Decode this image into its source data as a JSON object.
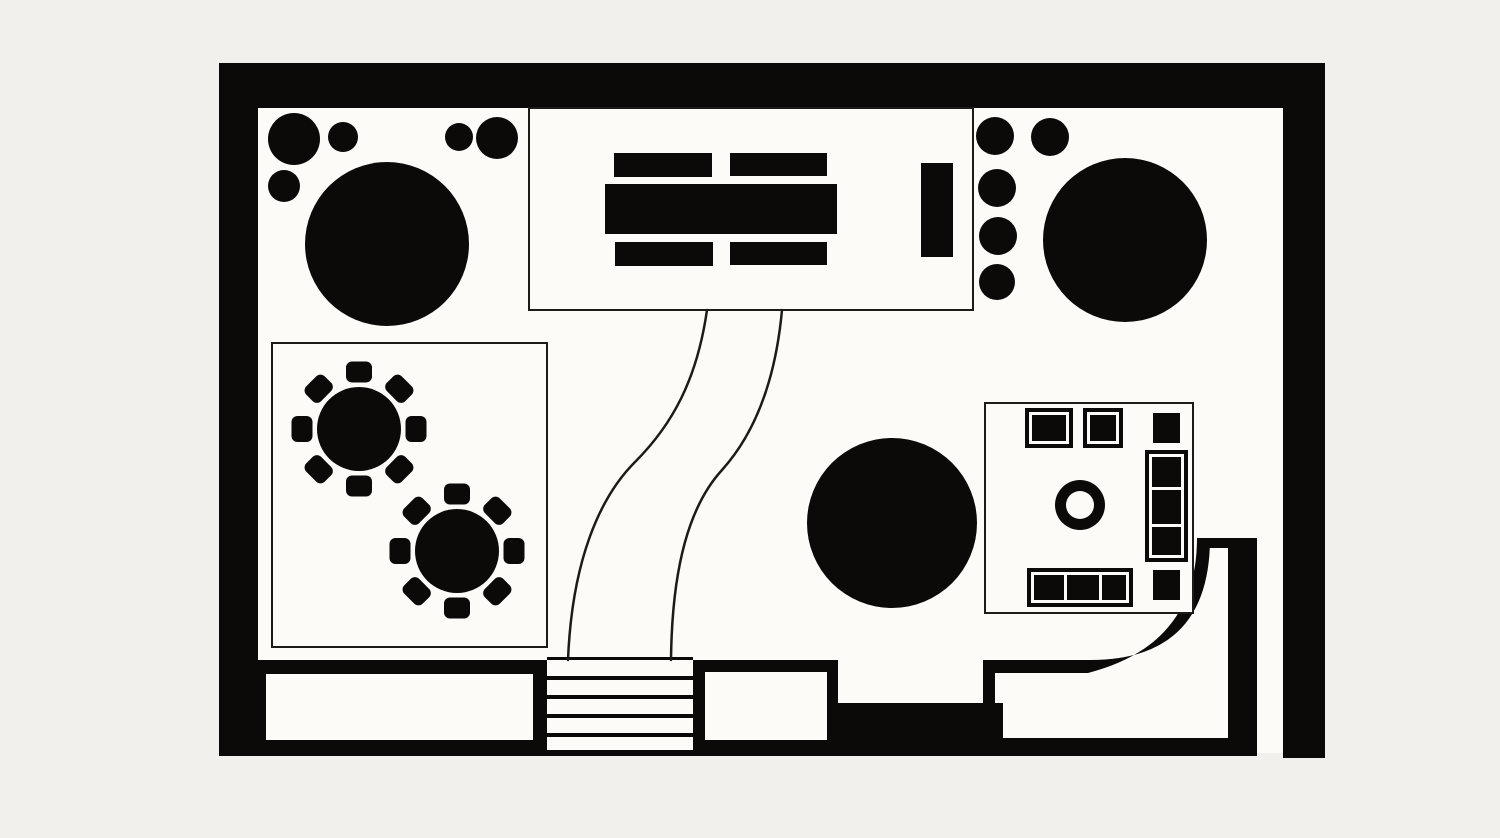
{
  "palette": {
    "ink": "#0b0a08",
    "floor": "#fcfbf8",
    "line": "#1c1b18",
    "outside": "#f1f0ec"
  },
  "plan": {
    "kind": "floor-plan",
    "style": "black-and-white",
    "canvas": {
      "width": 1500,
      "height": 838
    }
  },
  "shapes": [
    {
      "type": "rect",
      "name": "floor",
      "x": 258,
      "y": 108,
      "w": 1026,
      "h": 645,
      "fill": "floor"
    },
    {
      "type": "rect",
      "name": "wall-top",
      "x": 219,
      "y": 63,
      "w": 1106,
      "h": 45,
      "fill": "ink"
    },
    {
      "type": "rect",
      "name": "wall-left",
      "x": 219,
      "y": 63,
      "w": 39,
      "h": 693,
      "fill": "ink"
    },
    {
      "type": "rect",
      "name": "wall-right",
      "x": 1283,
      "y": 63,
      "w": 42,
      "h": 695,
      "fill": "ink"
    },
    {
      "type": "rect",
      "name": "wall-bottom-line",
      "x": 219,
      "y": 750,
      "w": 1038,
      "h": 6,
      "fill": "ink"
    },
    {
      "type": "rect",
      "name": "wall-bottom-left",
      "x": 258,
      "y": 660,
      "w": 289,
      "h": 93,
      "fill": "ink"
    },
    {
      "type": "rect",
      "name": "door-opening-left",
      "x": 266,
      "y": 674,
      "w": 267,
      "h": 66,
      "fill": "floor"
    },
    {
      "type": "rect",
      "name": "wall-bottom-mid",
      "x": 693,
      "y": 660,
      "w": 145,
      "h": 93,
      "fill": "ink"
    },
    {
      "type": "rect",
      "name": "door-opening-mid",
      "x": 705,
      "y": 672,
      "w": 122,
      "h": 68,
      "fill": "floor"
    },
    {
      "type": "rect",
      "name": "bench-platform",
      "x": 838,
      "y": 703,
      "w": 165,
      "h": 50,
      "fill": "ink"
    },
    {
      "type": "rect",
      "name": "wall-post",
      "x": 983,
      "y": 660,
      "w": 12,
      "h": 80,
      "fill": "ink"
    },
    {
      "type": "rect",
      "name": "wall-bottom-right-band",
      "x": 997,
      "y": 738,
      "w": 260,
      "h": 15,
      "fill": "ink"
    },
    {
      "type": "path",
      "name": "curved-wall",
      "d": "M995,660 H1090 Q1210,660 1210,538 L1197,538 Q1197,645 1088,673 L995,673 Z",
      "fill": "ink"
    },
    {
      "type": "rect",
      "name": "curved-wall-cap",
      "x": 1207,
      "y": 538,
      "w": 50,
      "h": 10,
      "fill": "ink"
    },
    {
      "type": "rect",
      "name": "wall-right-inner",
      "x": 1228,
      "y": 548,
      "w": 29,
      "h": 205,
      "fill": "ink"
    },
    {
      "type": "rect",
      "name": "stairs-top-edge",
      "x": 547,
      "y": 657,
      "w": 146,
      "h": 3,
      "fill": "ink"
    },
    {
      "type": "rect",
      "name": "stair-tread-1",
      "x": 547,
      "y": 676,
      "w": 146,
      "h": 4,
      "fill": "ink"
    },
    {
      "type": "rect",
      "name": "stair-tread-2",
      "x": 547,
      "y": 695,
      "w": 146,
      "h": 4,
      "fill": "ink"
    },
    {
      "type": "rect",
      "name": "stair-tread-3",
      "x": 547,
      "y": 714,
      "w": 146,
      "h": 4,
      "fill": "ink"
    },
    {
      "type": "rect",
      "name": "stair-tread-4",
      "x": 547,
      "y": 733,
      "w": 146,
      "h": 4,
      "fill": "ink"
    },
    {
      "type": "rect",
      "name": "room-conference",
      "x": 529,
      "y": 108,
      "w": 444,
      "h": 202,
      "fill": "floor",
      "stroke": "line",
      "sw": 2
    },
    {
      "type": "rect",
      "name": "conference-chair-nw",
      "x": 614,
      "y": 153,
      "w": 98,
      "h": 24,
      "fill": "ink"
    },
    {
      "type": "rect",
      "name": "conference-chair-ne",
      "x": 730,
      "y": 153,
      "w": 97,
      "h": 23,
      "fill": "ink"
    },
    {
      "type": "rect",
      "name": "conference-table",
      "x": 605,
      "y": 184,
      "w": 232,
      "h": 50,
      "fill": "ink"
    },
    {
      "type": "rect",
      "name": "conference-chair-sw",
      "x": 615,
      "y": 242,
      "w": 98,
      "h": 24,
      "fill": "ink"
    },
    {
      "type": "rect",
      "name": "conference-chair-se",
      "x": 730,
      "y": 242,
      "w": 97,
      "h": 23,
      "fill": "ink"
    },
    {
      "type": "rect",
      "name": "lectern",
      "x": 921,
      "y": 163,
      "w": 32,
      "h": 94,
      "fill": "ink"
    },
    {
      "type": "path",
      "name": "walkway-curve-left",
      "d": "M707,310 C697,380 672,425 635,462 C600,497 572,560 568,660",
      "stroke": "line",
      "sw": 2.5
    },
    {
      "type": "path",
      "name": "walkway-curve-right",
      "d": "M782,310 C776,375 758,430 722,470 C690,505 672,565 671,660",
      "stroke": "line",
      "sw": 2.5
    },
    {
      "type": "circle",
      "name": "planter-large-topleft",
      "cx": 294,
      "cy": 139,
      "r": 26,
      "fill": "ink"
    },
    {
      "type": "circle",
      "name": "planter-small-topleft-1",
      "cx": 343,
      "cy": 137,
      "r": 15,
      "fill": "ink"
    },
    {
      "type": "circle",
      "name": "planter-small-topleft-2",
      "cx": 459,
      "cy": 137,
      "r": 14,
      "fill": "ink"
    },
    {
      "type": "circle",
      "name": "planter-small-topleft-3",
      "cx": 497,
      "cy": 138,
      "r": 21,
      "fill": "ink"
    },
    {
      "type": "circle",
      "name": "planter-small-topleft-4",
      "cx": 284,
      "cy": 186,
      "r": 16,
      "fill": "ink"
    },
    {
      "type": "circle",
      "name": "round-table-large-topleft",
      "cx": 387,
      "cy": 244,
      "r": 82,
      "fill": "ink"
    },
    {
      "type": "circle",
      "name": "planter-topright-1",
      "cx": 995,
      "cy": 136,
      "r": 19,
      "fill": "ink"
    },
    {
      "type": "circle",
      "name": "planter-topright-2",
      "cx": 1050,
      "cy": 137,
      "r": 19,
      "fill": "ink"
    },
    {
      "type": "circle",
      "name": "planter-topright-3",
      "cx": 997,
      "cy": 188,
      "r": 19,
      "fill": "ink"
    },
    {
      "type": "circle",
      "name": "planter-topright-4",
      "cx": 998,
      "cy": 236,
      "r": 19,
      "fill": "ink"
    },
    {
      "type": "circle",
      "name": "planter-topright-5",
      "cx": 997,
      "cy": 282,
      "r": 18,
      "fill": "ink"
    },
    {
      "type": "circle",
      "name": "round-table-large-topright",
      "cx": 1125,
      "cy": 240,
      "r": 82,
      "fill": "ink"
    },
    {
      "type": "rect",
      "name": "room-dining",
      "x": 272,
      "y": 343,
      "w": 275,
      "h": 304,
      "fill": "floor",
      "stroke": "line",
      "sw": 2
    },
    {
      "type": "round-table",
      "name": "dining-table-1",
      "cx": 359,
      "cy": 429,
      "r": 42,
      "chairDist": 57,
      "chairW": 26,
      "chairH": 21,
      "chairRx": 6,
      "count": 8,
      "startDeg": -90
    },
    {
      "type": "round-table",
      "name": "dining-table-2",
      "cx": 457,
      "cy": 551,
      "r": 42,
      "chairDist": 57,
      "chairW": 26,
      "chairH": 21,
      "chairRx": 6,
      "count": 8,
      "startDeg": -90
    },
    {
      "type": "circle",
      "name": "round-table-large-center",
      "cx": 892,
      "cy": 523,
      "r": 85,
      "fill": "ink"
    },
    {
      "type": "rect",
      "name": "room-lounge",
      "x": 985,
      "y": 403,
      "w": 208,
      "h": 210,
      "fill": "floor",
      "stroke": "line",
      "sw": 2
    },
    {
      "type": "rect",
      "name": "armchair-1-frame",
      "x": 1025,
      "y": 408,
      "w": 48,
      "h": 40,
      "fill": "ink"
    },
    {
      "type": "rect",
      "name": "armchair-1-outline",
      "x": 1029,
      "y": 412,
      "w": 40,
      "h": 32,
      "fill": "floor"
    },
    {
      "type": "rect",
      "name": "armchair-1-cushion",
      "x": 1032,
      "y": 415,
      "w": 34,
      "h": 26,
      "fill": "ink"
    },
    {
      "type": "rect",
      "name": "armchair-2-frame",
      "x": 1083,
      "y": 408,
      "w": 40,
      "h": 40,
      "fill": "ink"
    },
    {
      "type": "rect",
      "name": "armchair-2-outline",
      "x": 1087,
      "y": 412,
      "w": 32,
      "h": 32,
      "fill": "floor"
    },
    {
      "type": "rect",
      "name": "armchair-2-cushion",
      "x": 1090,
      "y": 415,
      "w": 26,
      "h": 26,
      "fill": "ink"
    },
    {
      "type": "rect",
      "name": "side-table-top-right",
      "x": 1153,
      "y": 413,
      "w": 27,
      "h": 30,
      "fill": "ink"
    },
    {
      "type": "rect",
      "name": "sofa-right-frame",
      "x": 1145,
      "y": 450,
      "w": 43,
      "h": 112,
      "fill": "ink"
    },
    {
      "type": "rect",
      "name": "sofa-right-outline",
      "x": 1149,
      "y": 454,
      "w": 35,
      "h": 104,
      "fill": "floor"
    },
    {
      "type": "rect",
      "name": "sofa-right-cushions",
      "x": 1152,
      "y": 457,
      "w": 29,
      "h": 98,
      "fill": "ink"
    },
    {
      "type": "rect",
      "name": "sofa-right-divider-1",
      "x": 1149,
      "y": 487,
      "w": 35,
      "h": 3,
      "fill": "floor"
    },
    {
      "type": "rect",
      "name": "sofa-right-divider-2",
      "x": 1149,
      "y": 524,
      "w": 35,
      "h": 3,
      "fill": "floor"
    },
    {
      "type": "circle",
      "name": "coffee-table-ring-outer",
      "cx": 1080,
      "cy": 505,
      "r": 25,
      "fill": "ink"
    },
    {
      "type": "circle",
      "name": "coffee-table-ring-inner",
      "cx": 1080,
      "cy": 505,
      "r": 14,
      "fill": "floor"
    },
    {
      "type": "rect",
      "name": "sofa-bottom-frame",
      "x": 1027,
      "y": 568,
      "w": 106,
      "h": 39,
      "fill": "ink"
    },
    {
      "type": "rect",
      "name": "sofa-bottom-outline",
      "x": 1031,
      "y": 572,
      "w": 98,
      "h": 31,
      "fill": "floor"
    },
    {
      "type": "rect",
      "name": "sofa-bottom-cushions",
      "x": 1034,
      "y": 575,
      "w": 92,
      "h": 25,
      "fill": "ink"
    },
    {
      "type": "rect",
      "name": "sofa-bottom-divider-1",
      "x": 1064,
      "y": 572,
      "w": 3,
      "h": 31,
      "fill": "floor"
    },
    {
      "type": "rect",
      "name": "sofa-bottom-divider-2",
      "x": 1099,
      "y": 572,
      "w": 3,
      "h": 31,
      "fill": "floor"
    },
    {
      "type": "rect",
      "name": "side-table-bottom-right",
      "x": 1153,
      "y": 570,
      "w": 27,
      "h": 30,
      "fill": "ink"
    }
  ]
}
